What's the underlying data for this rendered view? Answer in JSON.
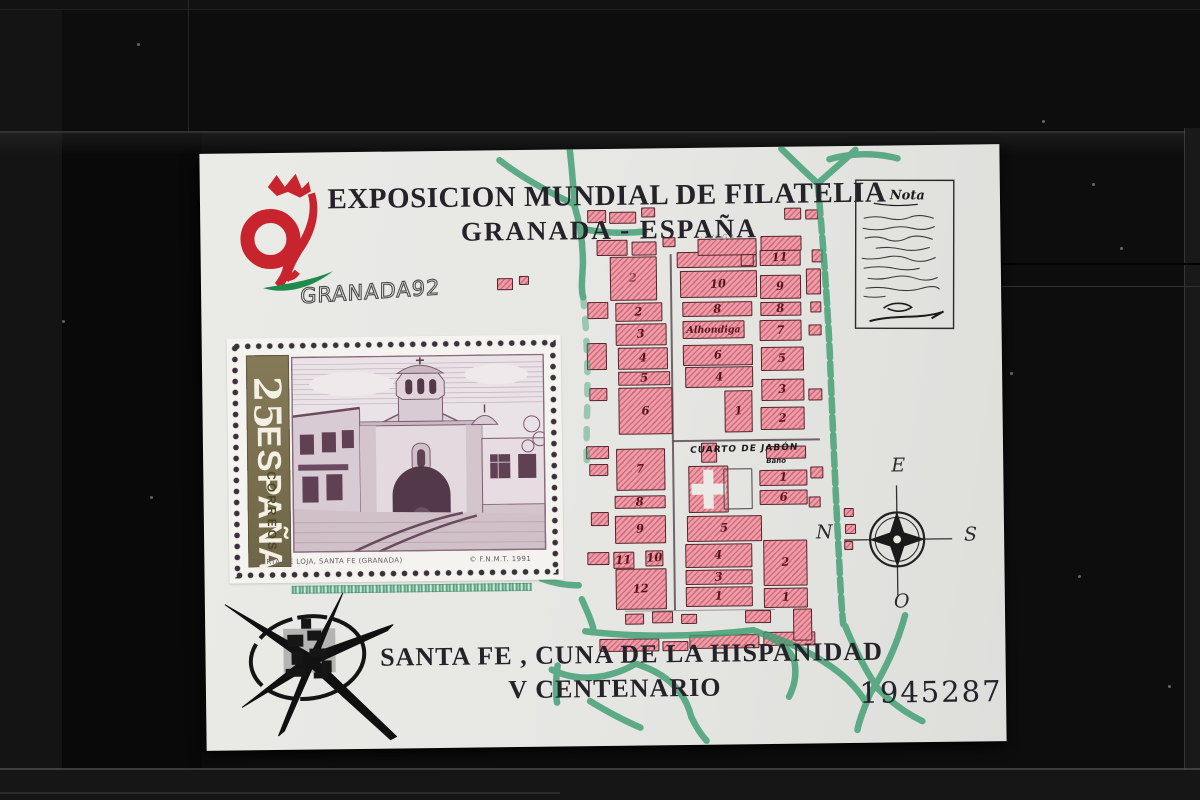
{
  "photo": {
    "background_color": "#0d0d0d",
    "sleeve": "black stockbook strip"
  },
  "sheet": {
    "header": {
      "title": "EXPOSICION MUNDIAL DE FILATELIA",
      "subtitle": "GRANADA - ESPAÑA"
    },
    "logo": {
      "wordmark": "GRANADA92",
      "red": "#c8242e",
      "green": "#1f8a4c"
    },
    "note": {
      "heading": "Nota"
    },
    "stamp": {
      "denomination": "25",
      "country": "ESPAÑA",
      "service": "CORREOS",
      "caption": "PUERTA DE LOJA, SANTA FE (GRANADA)",
      "imprint": "© F.N.M.T. 1991",
      "bar_color": "#7d7352",
      "engraving_color": "#7d5c70"
    },
    "map": {
      "vega_label": "· VEGA ·",
      "alhondiga_label": "Alhondiga",
      "cuarto_label": "CUARTO DE JABÓN",
      "bano_label": "Baño",
      "compass": {
        "east": "E",
        "south": "S",
        "west": "O",
        "north": "N"
      },
      "colors": {
        "block_fill": "#ef9da8",
        "block_border": "#56242b",
        "road_green": "#3f9e72",
        "number_ink": "#57141b"
      },
      "blocks": [
        {
          "x": 409,
          "y": 108,
          "w": 47,
          "h": 44,
          "label": "2",
          "dim": true
        },
        {
          "x": 414,
          "y": 154,
          "w": 47,
          "h": 19,
          "label": "2"
        },
        {
          "x": 414,
          "y": 175,
          "w": 51,
          "h": 22,
          "label": "3"
        },
        {
          "x": 416,
          "y": 199,
          "w": 50,
          "h": 22,
          "label": "4"
        },
        {
          "x": 416,
          "y": 223,
          "w": 52,
          "h": 14,
          "label": "5"
        },
        {
          "x": 416,
          "y": 239,
          "w": 54,
          "h": 47,
          "label": "6"
        },
        {
          "x": 476,
          "y": 104,
          "w": 80,
          "h": 16
        },
        {
          "x": 479,
          "y": 123,
          "w": 77,
          "h": 27,
          "label": "10"
        },
        {
          "x": 481,
          "y": 154,
          "w": 70,
          "h": 15,
          "label": "8"
        },
        {
          "x": 481,
          "y": 173,
          "w": 62,
          "h": 18,
          "label": "Alhondiga",
          "kind": "text"
        },
        {
          "x": 481,
          "y": 197,
          "w": 70,
          "h": 21,
          "label": "6"
        },
        {
          "x": 483,
          "y": 219,
          "w": 68,
          "h": 21,
          "label": "4"
        },
        {
          "x": 522,
          "y": 243,
          "w": 28,
          "h": 42,
          "label": "1"
        },
        {
          "x": 559,
          "y": 103,
          "w": 41,
          "h": 16,
          "label": "11"
        },
        {
          "x": 559,
          "y": 128,
          "w": 41,
          "h": 24,
          "label": "9"
        },
        {
          "x": 559,
          "y": 155,
          "w": 41,
          "h": 14,
          "label": "8"
        },
        {
          "x": 558,
          "y": 173,
          "w": 42,
          "h": 21,
          "label": "7"
        },
        {
          "x": 559,
          "y": 200,
          "w": 43,
          "h": 24,
          "label": "5"
        },
        {
          "x": 559,
          "y": 232,
          "w": 43,
          "h": 22,
          "label": "3"
        },
        {
          "x": 558,
          "y": 260,
          "w": 44,
          "h": 23,
          "label": "2"
        },
        {
          "x": 386,
          "y": 153,
          "w": 21,
          "h": 17
        },
        {
          "x": 385,
          "y": 194,
          "w": 20,
          "h": 27
        },
        {
          "x": 387,
          "y": 239,
          "w": 18,
          "h": 13
        },
        {
          "x": 383,
          "y": 297,
          "w": 23,
          "h": 13
        },
        {
          "x": 386,
          "y": 315,
          "w": 19,
          "h": 12
        },
        {
          "x": 387,
          "y": 363,
          "w": 18,
          "h": 14
        },
        {
          "x": 383,
          "y": 403,
          "w": 22,
          "h": 13
        },
        {
          "x": 605,
          "y": 122,
          "w": 15,
          "h": 26
        },
        {
          "x": 609,
          "y": 155,
          "w": 11,
          "h": 11
        },
        {
          "x": 607,
          "y": 178,
          "w": 13,
          "h": 11
        },
        {
          "x": 611,
          "y": 103,
          "w": 11,
          "h": 13
        },
        {
          "x": 606,
          "y": 242,
          "w": 14,
          "h": 12
        },
        {
          "x": 387,
          "y": 61,
          "w": 19,
          "h": 13
        },
        {
          "x": 409,
          "y": 63,
          "w": 27,
          "h": 12
        },
        {
          "x": 441,
          "y": 59,
          "w": 14,
          "h": 10
        },
        {
          "x": 396,
          "y": 91,
          "w": 31,
          "h": 16
        },
        {
          "x": 431,
          "y": 93,
          "w": 25,
          "h": 14
        },
        {
          "x": 462,
          "y": 89,
          "w": 13,
          "h": 10
        },
        {
          "x": 497,
          "y": 91,
          "w": 59,
          "h": 17
        },
        {
          "x": 560,
          "y": 89,
          "w": 41,
          "h": 15
        },
        {
          "x": 584,
          "y": 61,
          "w": 17,
          "h": 12
        },
        {
          "x": 605,
          "y": 63,
          "w": 13,
          "h": 10
        },
        {
          "x": 540,
          "y": 107,
          "w": 13,
          "h": 12
        },
        {
          "x": 296,
          "y": 128,
          "w": 16,
          "h": 12
        },
        {
          "x": 318,
          "y": 126,
          "w": 10,
          "h": 9
        },
        {
          "x": 413,
          "y": 300,
          "w": 49,
          "h": 42,
          "label": "7"
        },
        {
          "x": 411,
          "y": 347,
          "w": 51,
          "h": 13,
          "label": "8"
        },
        {
          "x": 411,
          "y": 367,
          "w": 51,
          "h": 28,
          "label": "9"
        },
        {
          "x": 409,
          "y": 403,
          "w": 21,
          "h": 17,
          "label": "11"
        },
        {
          "x": 441,
          "y": 402,
          "w": 18,
          "h": 16,
          "label": "10"
        },
        {
          "x": 411,
          "y": 420,
          "w": 51,
          "h": 41,
          "label": "12"
        },
        {
          "x": 485,
          "y": 318,
          "w": 40,
          "h": 47,
          "kind": "cross"
        },
        {
          "x": 520,
          "y": 321,
          "w": 29,
          "h": 41,
          "kind": "outline"
        },
        {
          "x": 498,
          "y": 295,
          "w": 16,
          "h": 20
        },
        {
          "x": 483,
          "y": 368,
          "w": 75,
          "h": 26,
          "label": "5"
        },
        {
          "x": 481,
          "y": 396,
          "w": 67,
          "h": 24,
          "label": "4"
        },
        {
          "x": 481,
          "y": 422,
          "w": 67,
          "h": 15,
          "label": "3"
        },
        {
          "x": 481,
          "y": 439,
          "w": 67,
          "h": 20,
          "label": "1"
        },
        {
          "x": 563,
          "y": 299,
          "w": 40,
          "h": 13
        },
        {
          "x": 556,
          "y": 323,
          "w": 48,
          "h": 16,
          "label": "1"
        },
        {
          "x": 556,
          "y": 343,
          "w": 48,
          "h": 15,
          "label": "6"
        },
        {
          "x": 559,
          "y": 393,
          "w": 44,
          "h": 46,
          "label": "2"
        },
        {
          "x": 559,
          "y": 441,
          "w": 44,
          "h": 20,
          "label": "1"
        },
        {
          "x": 607,
          "y": 320,
          "w": 13,
          "h": 12
        },
        {
          "x": 605,
          "y": 350,
          "w": 12,
          "h": 11
        },
        {
          "x": 640,
          "y": 362,
          "w": 10,
          "h": 9
        },
        {
          "x": 641,
          "y": 378,
          "w": 11,
          "h": 10
        },
        {
          "x": 640,
          "y": 395,
          "w": 9,
          "h": 9
        },
        {
          "x": 394,
          "y": 490,
          "w": 60,
          "h": 13
        },
        {
          "x": 457,
          "y": 493,
          "w": 26,
          "h": 10
        },
        {
          "x": 484,
          "y": 487,
          "w": 70,
          "h": 14
        },
        {
          "x": 558,
          "y": 485,
          "w": 52,
          "h": 14
        },
        {
          "x": 588,
          "y": 462,
          "w": 19,
          "h": 32
        },
        {
          "x": 420,
          "y": 465,
          "w": 19,
          "h": 11
        },
        {
          "x": 447,
          "y": 463,
          "w": 21,
          "h": 12
        },
        {
          "x": 476,
          "y": 466,
          "w": 16,
          "h": 10
        },
        {
          "x": 540,
          "y": 463,
          "w": 26,
          "h": 13
        }
      ]
    },
    "footer": {
      "line1": "SANTA FE , CUNA DE LA HISPANIDAD",
      "line2": "V CENTENARIO",
      "serial_number": "1945287"
    }
  }
}
